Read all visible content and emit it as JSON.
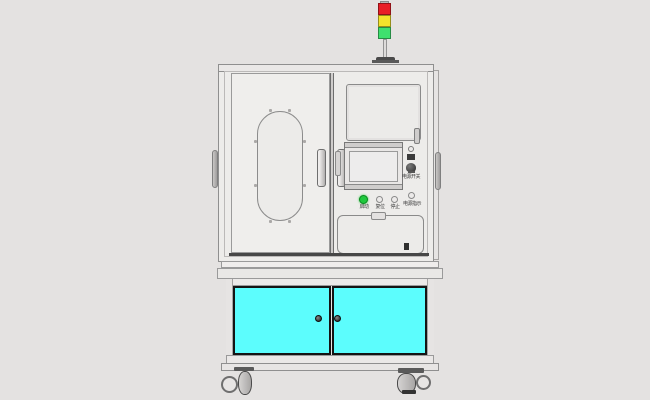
{
  "scene": {
    "background": "#e4e2e1",
    "machine_fill": "#edecea",
    "panel_fill": "#ecebe9",
    "outline": "#8f8f8f",
    "cyan_door": "#5cfdfd"
  },
  "tower_light": {
    "red": "#e81e26",
    "yellow": "#f3e32c",
    "green": "#3fe06e"
  },
  "controls": {
    "start_button": {
      "label": "启动",
      "color": "#1fc83d"
    },
    "reset_button": {
      "label": "复位",
      "color": "#eceae9"
    },
    "stop_button": {
      "label": "停止",
      "color": "#eceae9"
    },
    "indicator_button": {
      "label": "电源指示",
      "color": "#eceae9"
    },
    "power_switch_label": "电源开关"
  }
}
